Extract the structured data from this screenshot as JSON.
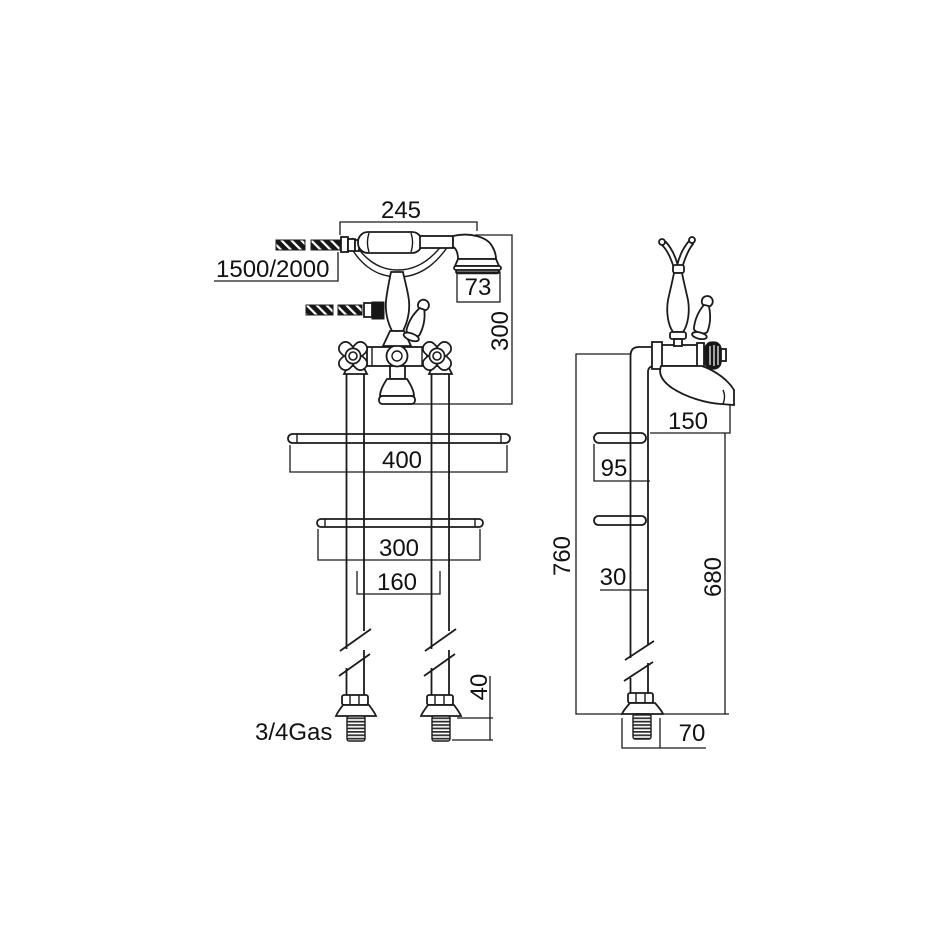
{
  "document": {
    "type": "technical-dimension-drawing",
    "colors": {
      "line": "#1b1b1b",
      "background": "#ffffff"
    }
  },
  "labels": {
    "handset_length": "245",
    "hose_length": "1500/2000",
    "handset_head_diameter": "73",
    "riser_height": "300",
    "stay_bar_long": "400",
    "stay_bar_short": "300",
    "pipe_centres": "160",
    "thread_length": "40",
    "connection_thread": "3/4Gas",
    "spout_projection": "150",
    "stay_offset_upper": "95",
    "stay_offset_lower": "30",
    "overall_height": "760",
    "spout_height": "680",
    "base_diameter": "70"
  }
}
